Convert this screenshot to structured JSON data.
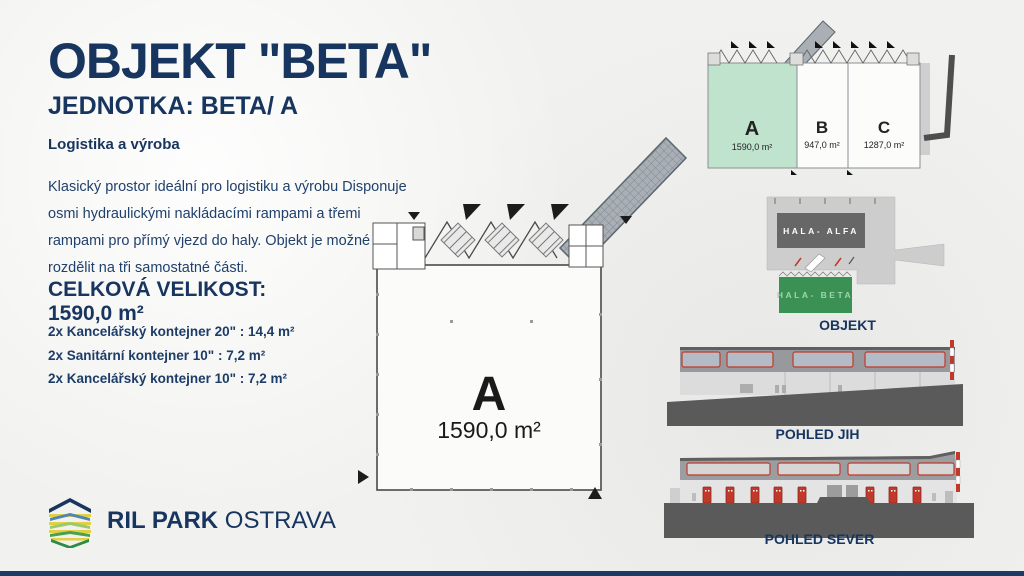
{
  "header": {
    "title": "OBJEKT \"BETA\"",
    "subtitle": "JEDNOTKA: BETA/ A",
    "category": "Logistika a výroba"
  },
  "description_lines": [
    "Klasický prostor ideální pro logistiku a výrobu Disponuje",
    "osmi hydraulickými nakládacími rampami a třemi",
    "rampami pro přímý vjezd do haly. Objekt je možné",
    "rozdělit na tři samostatné části."
  ],
  "size": {
    "heading": "CELKOVÁ VELIKOST:",
    "value": "1590,0 m²"
  },
  "specs": [
    "2x Kancelářský kontejner 20\" : 14,4 m²",
    "2x Sanitární kontejner 10\" : 7,2 m²",
    "2x Kancelářský kontejner 10\" : 7,2 m²"
  ],
  "brand": {
    "bold": "RIL PARK",
    "light": "OSTRAVA",
    "logo_icon": "layered-hexagon-icon"
  },
  "floorplan": {
    "unit": "A",
    "area": "1590,0 m²"
  },
  "units_overview": {
    "units": [
      {
        "label": "A",
        "area": "1590,0 m²",
        "highlighted": true
      },
      {
        "label": "B",
        "area": "947,0 m²",
        "highlighted": false
      },
      {
        "label": "C",
        "area": "1287,0 m²",
        "highlighted": false
      }
    ]
  },
  "site_plan": {
    "halls": [
      {
        "name": "HALA- ALFA"
      },
      {
        "name": "HALA- BETA"
      }
    ],
    "caption": "OBJEKT"
  },
  "elevations": {
    "south_caption": "POHLED JIH",
    "north_caption": "POHLED SEVER"
  },
  "colors": {
    "navy": "#1b3a64",
    "unit_a_green": "#bfe3cd",
    "hall_beta_green": "#3b9154",
    "hall_alfa_gray": "#676767",
    "dock_red": "#c0392b",
    "ground_gray": "#5a5a5a"
  }
}
